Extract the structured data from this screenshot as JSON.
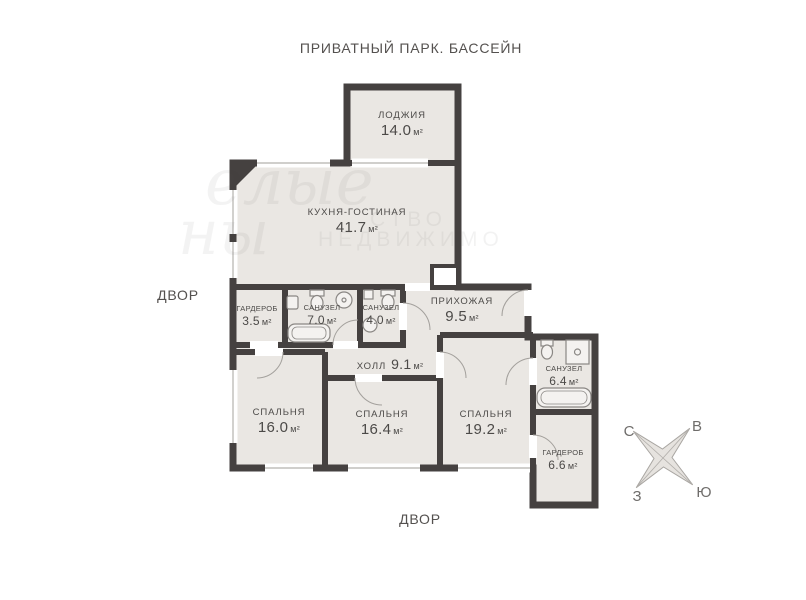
{
  "page": {
    "title_top": "ПРИВАТНЫЙ ПАРК. БАССЕЙН",
    "label_left": "ДВОР",
    "label_bottom": "ДВОР"
  },
  "colors": {
    "wall": "#454140",
    "room_fill": "#eae7e3",
    "label_text": "#4c4a48",
    "window_line": "#b5b2ae",
    "door_arc": "#a3a09c",
    "compass_fill": "#e6e3df"
  },
  "rooms": [
    {
      "name": "ЛОДЖИЯ",
      "area": "14.0",
      "unit": "м²"
    },
    {
      "name": "КУХНЯ-ГОСТИНАЯ",
      "area": "41.7",
      "unit": "м²"
    },
    {
      "name": "ГАРДЕРОБ",
      "area": "3.5",
      "unit": "м²"
    },
    {
      "name": "САНУЗЕЛ",
      "area": "7.0",
      "unit": "м²"
    },
    {
      "name": "САНУЗЕЛ",
      "area": "4.0",
      "unit": "м²"
    },
    {
      "name": "ПРИХОЖАЯ",
      "area": "9.5",
      "unit": "м²"
    },
    {
      "name": "ХОЛЛ",
      "area": "9.1",
      "unit": "м²"
    },
    {
      "name": "СПАЛЬНЯ",
      "area": "16.0",
      "unit": "м²"
    },
    {
      "name": "СПАЛЬНЯ",
      "area": "16.4",
      "unit": "м²"
    },
    {
      "name": "СПАЛЬНЯ",
      "area": "19.2",
      "unit": "м²"
    },
    {
      "name": "САНУЗЕЛ",
      "area": "6.4",
      "unit": "м²"
    },
    {
      "name": "ГАРДЕРОБ",
      "area": "6.6",
      "unit": "м²"
    }
  ],
  "compass": {
    "north": "С",
    "east": "В",
    "west": "З",
    "south": "Ю"
  },
  "watermark": {
    "script_1": "елые",
    "script_2": "ны",
    "caps_1": "СТВО",
    "caps_2": "НЕДВИЖИМО"
  }
}
